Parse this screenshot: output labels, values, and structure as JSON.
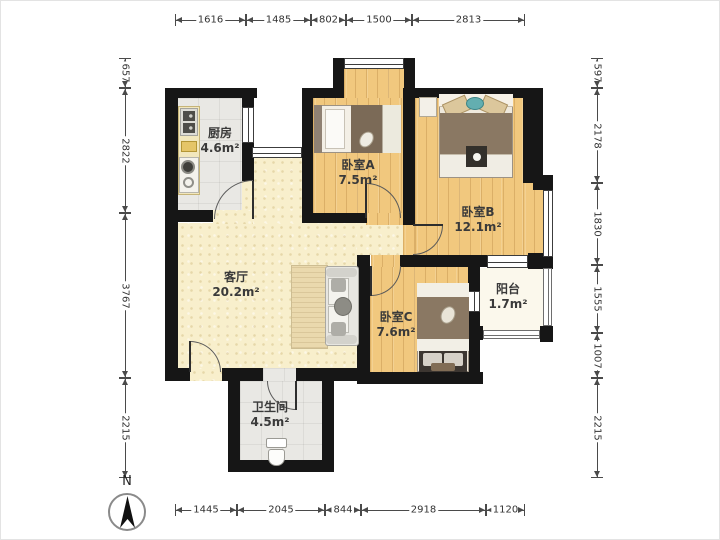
{
  "plan": {
    "rooms": [
      {
        "id": "kitchen",
        "name": "厨房",
        "area": "4.6m²"
      },
      {
        "id": "bedroomA",
        "name": "卧室A",
        "area": "7.5m²"
      },
      {
        "id": "bedroomB",
        "name": "卧室B",
        "area": "12.1m²"
      },
      {
        "id": "living",
        "name": "客厅",
        "area": "20.2m²"
      },
      {
        "id": "bedroomC",
        "name": "卧室C",
        "area": "7.6m²"
      },
      {
        "id": "balcony",
        "name": "阳台",
        "area": "1.7m²"
      },
      {
        "id": "bathroom",
        "name": "卫生间",
        "area": "4.5m²"
      }
    ]
  },
  "dimensions_mm": {
    "top": [
      "1616",
      "1485",
      "802",
      "1500",
      "2813"
    ],
    "bottom": [
      "1445",
      "2045",
      "844",
      "2918",
      "1120"
    ],
    "left": [
      "657",
      "2822",
      "3767",
      "2215"
    ],
    "right": [
      "597",
      "2178",
      "1830",
      "1555",
      "1007",
      "2215"
    ]
  },
  "compass": {
    "label": "N"
  },
  "colors": {
    "wall": "#161616",
    "wood_floor": "#f1c87e",
    "living_floor": "#f8efcc",
    "tile_floor": "#e9e8e4",
    "balcony_floor": "#fbf8ec",
    "dimension_line": "#4a4a4a",
    "blanket_brown": "#8a7863",
    "teal_pillow": "#63aeb0"
  }
}
